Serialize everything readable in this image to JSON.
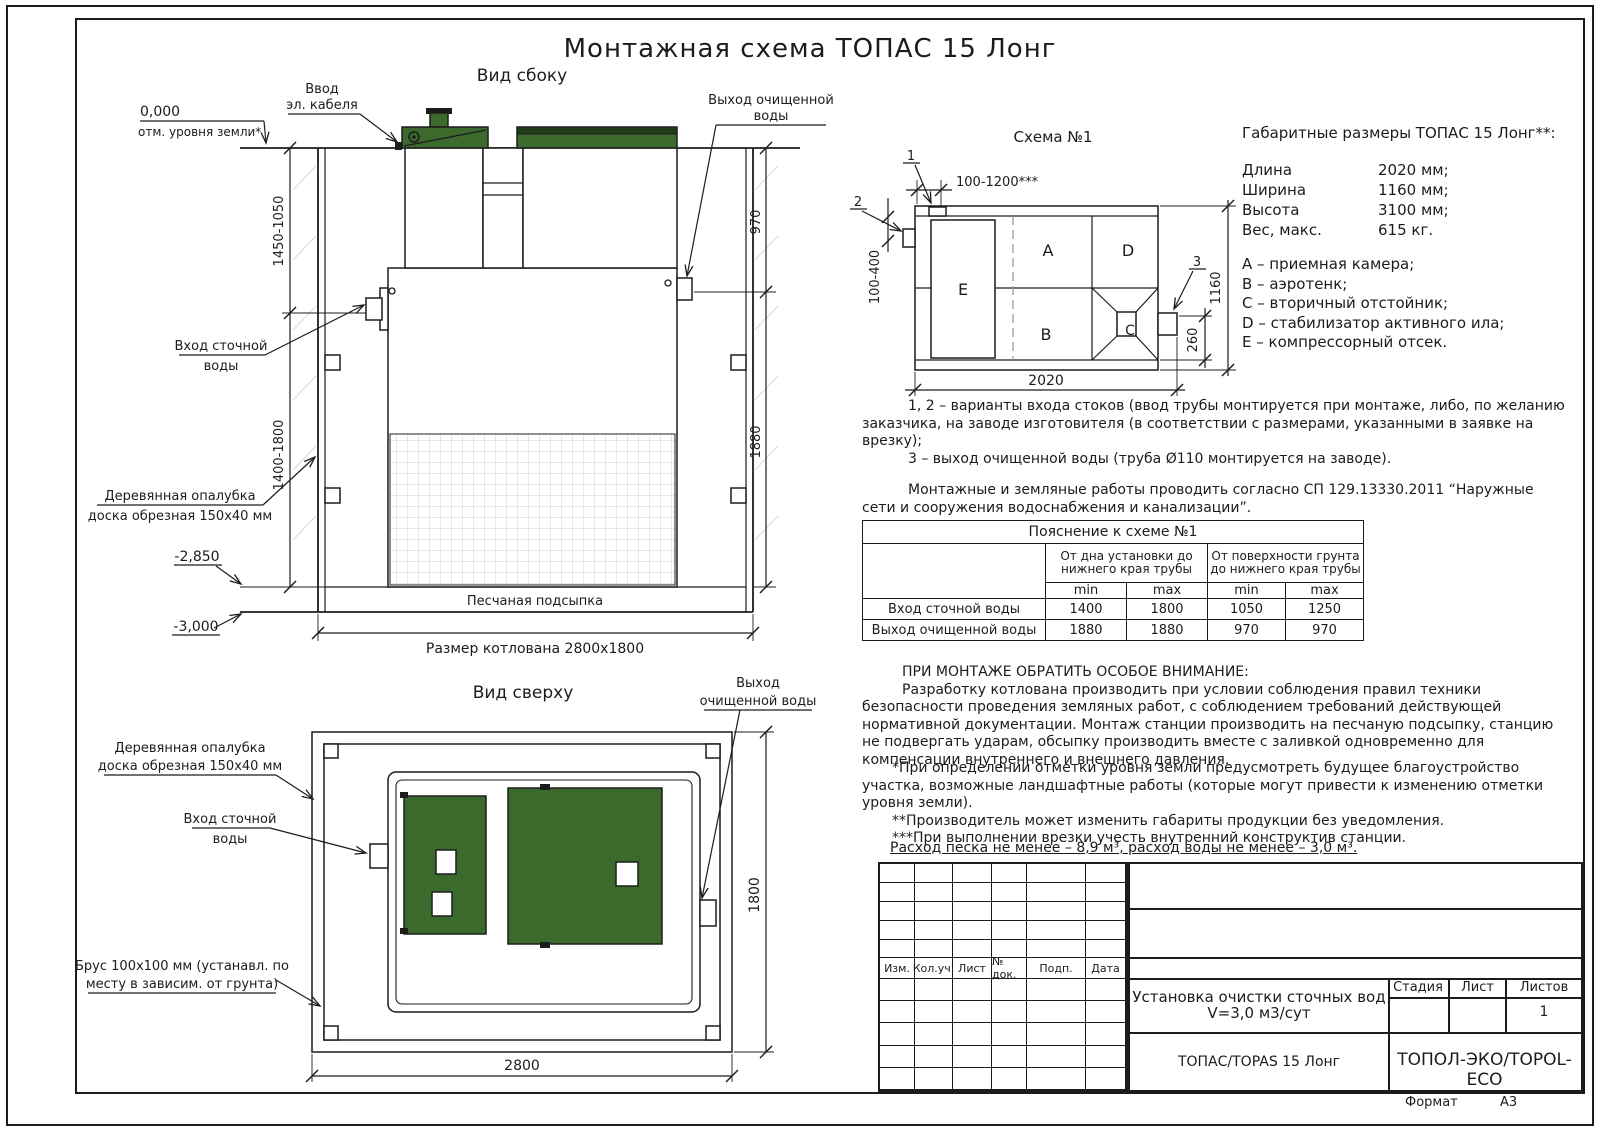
{
  "page": {
    "title": "Монтажная схема ТОПАС 15 Лонг",
    "format_label": "Формат",
    "format_value": "А3"
  },
  "colors": {
    "lid_green": "#3c6a2c",
    "lid_dark_band": "#203c16",
    "line": "#1c1c1c"
  },
  "side_view": {
    "title": "Вид сбоку",
    "ground_mark": "0,000",
    "ground_label": "отм. уровня земли*",
    "cable_line1": "Ввод",
    "cable_line2": "эл. кабеля",
    "outlet_line1": "Выход очищенной",
    "outlet_line2": "воды",
    "inlet_line1": "Вход сточной",
    "inlet_line2": "воды",
    "formwork_line1": "Деревянная опалубка",
    "formwork_line2": "доска обрезная 150х40 мм",
    "level_sand": "-2,850",
    "level_bottom": "-3,000",
    "sand_label": "Песчаная подсыпка",
    "pit_dim": "Размер котлована 2800х1800",
    "dim_left_upper": "1450-1050",
    "dim_left_lower": "1400-1800",
    "dim_right_upper": "970",
    "dim_right_lower": "1880"
  },
  "top_view": {
    "title": "Вид сверху",
    "formwork_line1": "Деревянная опалубка",
    "formwork_line2": "доска обрезная 150х40 мм",
    "inlet_line1": "Вход сточной",
    "inlet_line2": "воды",
    "outlet_line1": "Выход",
    "outlet_line2": "очищенной воды",
    "beam_line1": "Брус 100х100 мм (устанавл. по",
    "beam_line2": "месту в зависим. от грунта)",
    "dim_width": "2800",
    "dim_height": "1800"
  },
  "schema": {
    "title": "Схема №1",
    "callout1": "1",
    "callout2": "2",
    "callout3": "3",
    "comp_a": "A",
    "comp_b": "B",
    "comp_c": "C",
    "comp_d": "D",
    "comp_e": "E",
    "dim_top": "100-1200***",
    "dim_left": "100-400",
    "dim_right": "1160",
    "dim_outlet": "260",
    "dim_bottom": "2020"
  },
  "specs": {
    "heading": "Габаритные размеры ТОПАС 15 Лонг**:",
    "rows": [
      {
        "label": "Длина",
        "value": "2020 мм;"
      },
      {
        "label": "Ширина",
        "value": "1160 мм;"
      },
      {
        "label": "Высота",
        "value": "3100 мм;"
      },
      {
        "label": "Вес, макс.",
        "value": "615 кг."
      }
    ],
    "legend": [
      "A – приемная камера;",
      "B – аэротенк;",
      "C – вторичный отстойник;",
      "D – стабилизатор активного ила;",
      "E – компрессорный отсек."
    ]
  },
  "notes": {
    "item12": "1, 2 – варианты входа стоков (ввод трубы монтируется при монтаже, либо, по желанию заказчика, на заводе изготовителя (в соответствии с размерами, указанными в заявке на врезку);",
    "item3": "3 – выход очищенной воды (труба Ø110 монтируется на заводе).",
    "sp": "Монтажные и земляные работы проводить согласно СП 129.13330.2011 “Наружные сети и сооружения водоснабжения и канализации”."
  },
  "table": {
    "caption": "Пояснение к схеме №1",
    "group1": "От дна установки до нижнего края трубы",
    "group2": "От поверхности грунта до нижнего края трубы",
    "min1": "min",
    "max1": "max",
    "min2": "min",
    "max2": "max",
    "rows": [
      {
        "name": "Вход сточной воды",
        "v1": "1400",
        "v2": "1800",
        "v3": "1050",
        "v4": "1250"
      },
      {
        "name": "Выход очищенной воды",
        "v1": "1880",
        "v2": "1880",
        "v3": "970",
        "v4": "970"
      }
    ]
  },
  "warning": {
    "heading": "ПРИ МОНТАЖЕ ОБРАТИТЬ ОСОБОЕ ВНИМАНИЕ:",
    "body": "Разработку котлована производить при условии соблюдения правил техники безопасности проведения земляных работ, с соблюдением требований действующей нормативной документации. Монтаж станции производить на песчаную подсыпку, станцию не подвергать ударам, обсыпку производить вместе с заливкой одновременно для компенсации внутреннего и внешнего давления.",
    "fn1": "*При определении отметки уровня земли предусмотреть будущее благоустройство участка, возможные ландшафтные работы (которые могут привести к изменению отметки уровня земли).",
    "fn2": "**Производитель может изменить габариты продукции без уведомления.",
    "fn3": "***При выполнении врезки учесть внутренний конструктив станции.",
    "consumption": "Расход песка не менее – 8,9 м³, расход воды не менее – 3,0 м³."
  },
  "title_block": {
    "rev_headers": [
      "Изм.",
      "Кол.уч.",
      "Лист",
      "№ док.",
      "Подп.",
      "Дата"
    ],
    "doc_title": "Установка очистки сточных вод",
    "doc_volume": "V=3,0 м3/сут",
    "stage_label": "Стадия",
    "sheet_label": "Лист",
    "sheets_label": "Листов",
    "sheets_value": "1",
    "product": "ТОПАС/TOPAS 15 Лонг",
    "company": "ТОПОЛ-ЭКО/TOPOL-ECO"
  }
}
